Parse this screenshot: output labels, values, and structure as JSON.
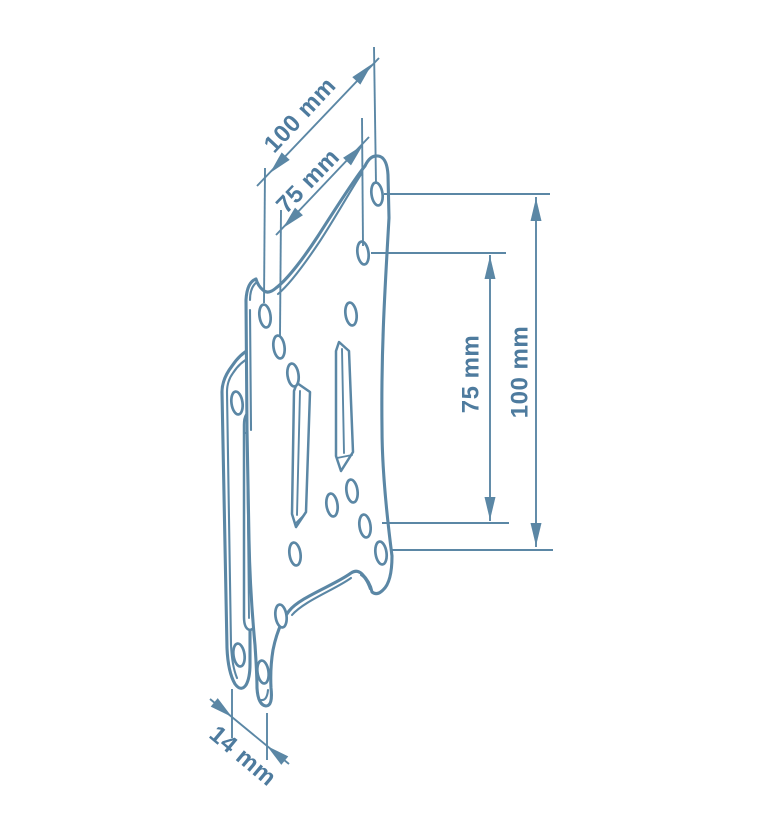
{
  "figure": {
    "title": "VESA wall-mount bracket technical drawing",
    "type": "line-drawing",
    "background_color": "#ffffff",
    "line_color": "#5b87a5",
    "text_color": "#4e7b9e",
    "dimensions": [
      {
        "id": "hole-spacing-horizontal-outer",
        "label": "100 mm"
      },
      {
        "id": "hole-spacing-horizontal-inner",
        "label": "75 mm"
      },
      {
        "id": "hole-spacing-vertical-inner",
        "label": "75 mm"
      },
      {
        "id": "hole-spacing-vertical-outer",
        "label": "100 mm"
      },
      {
        "id": "plate-depth",
        "label": "14 mm"
      }
    ]
  }
}
